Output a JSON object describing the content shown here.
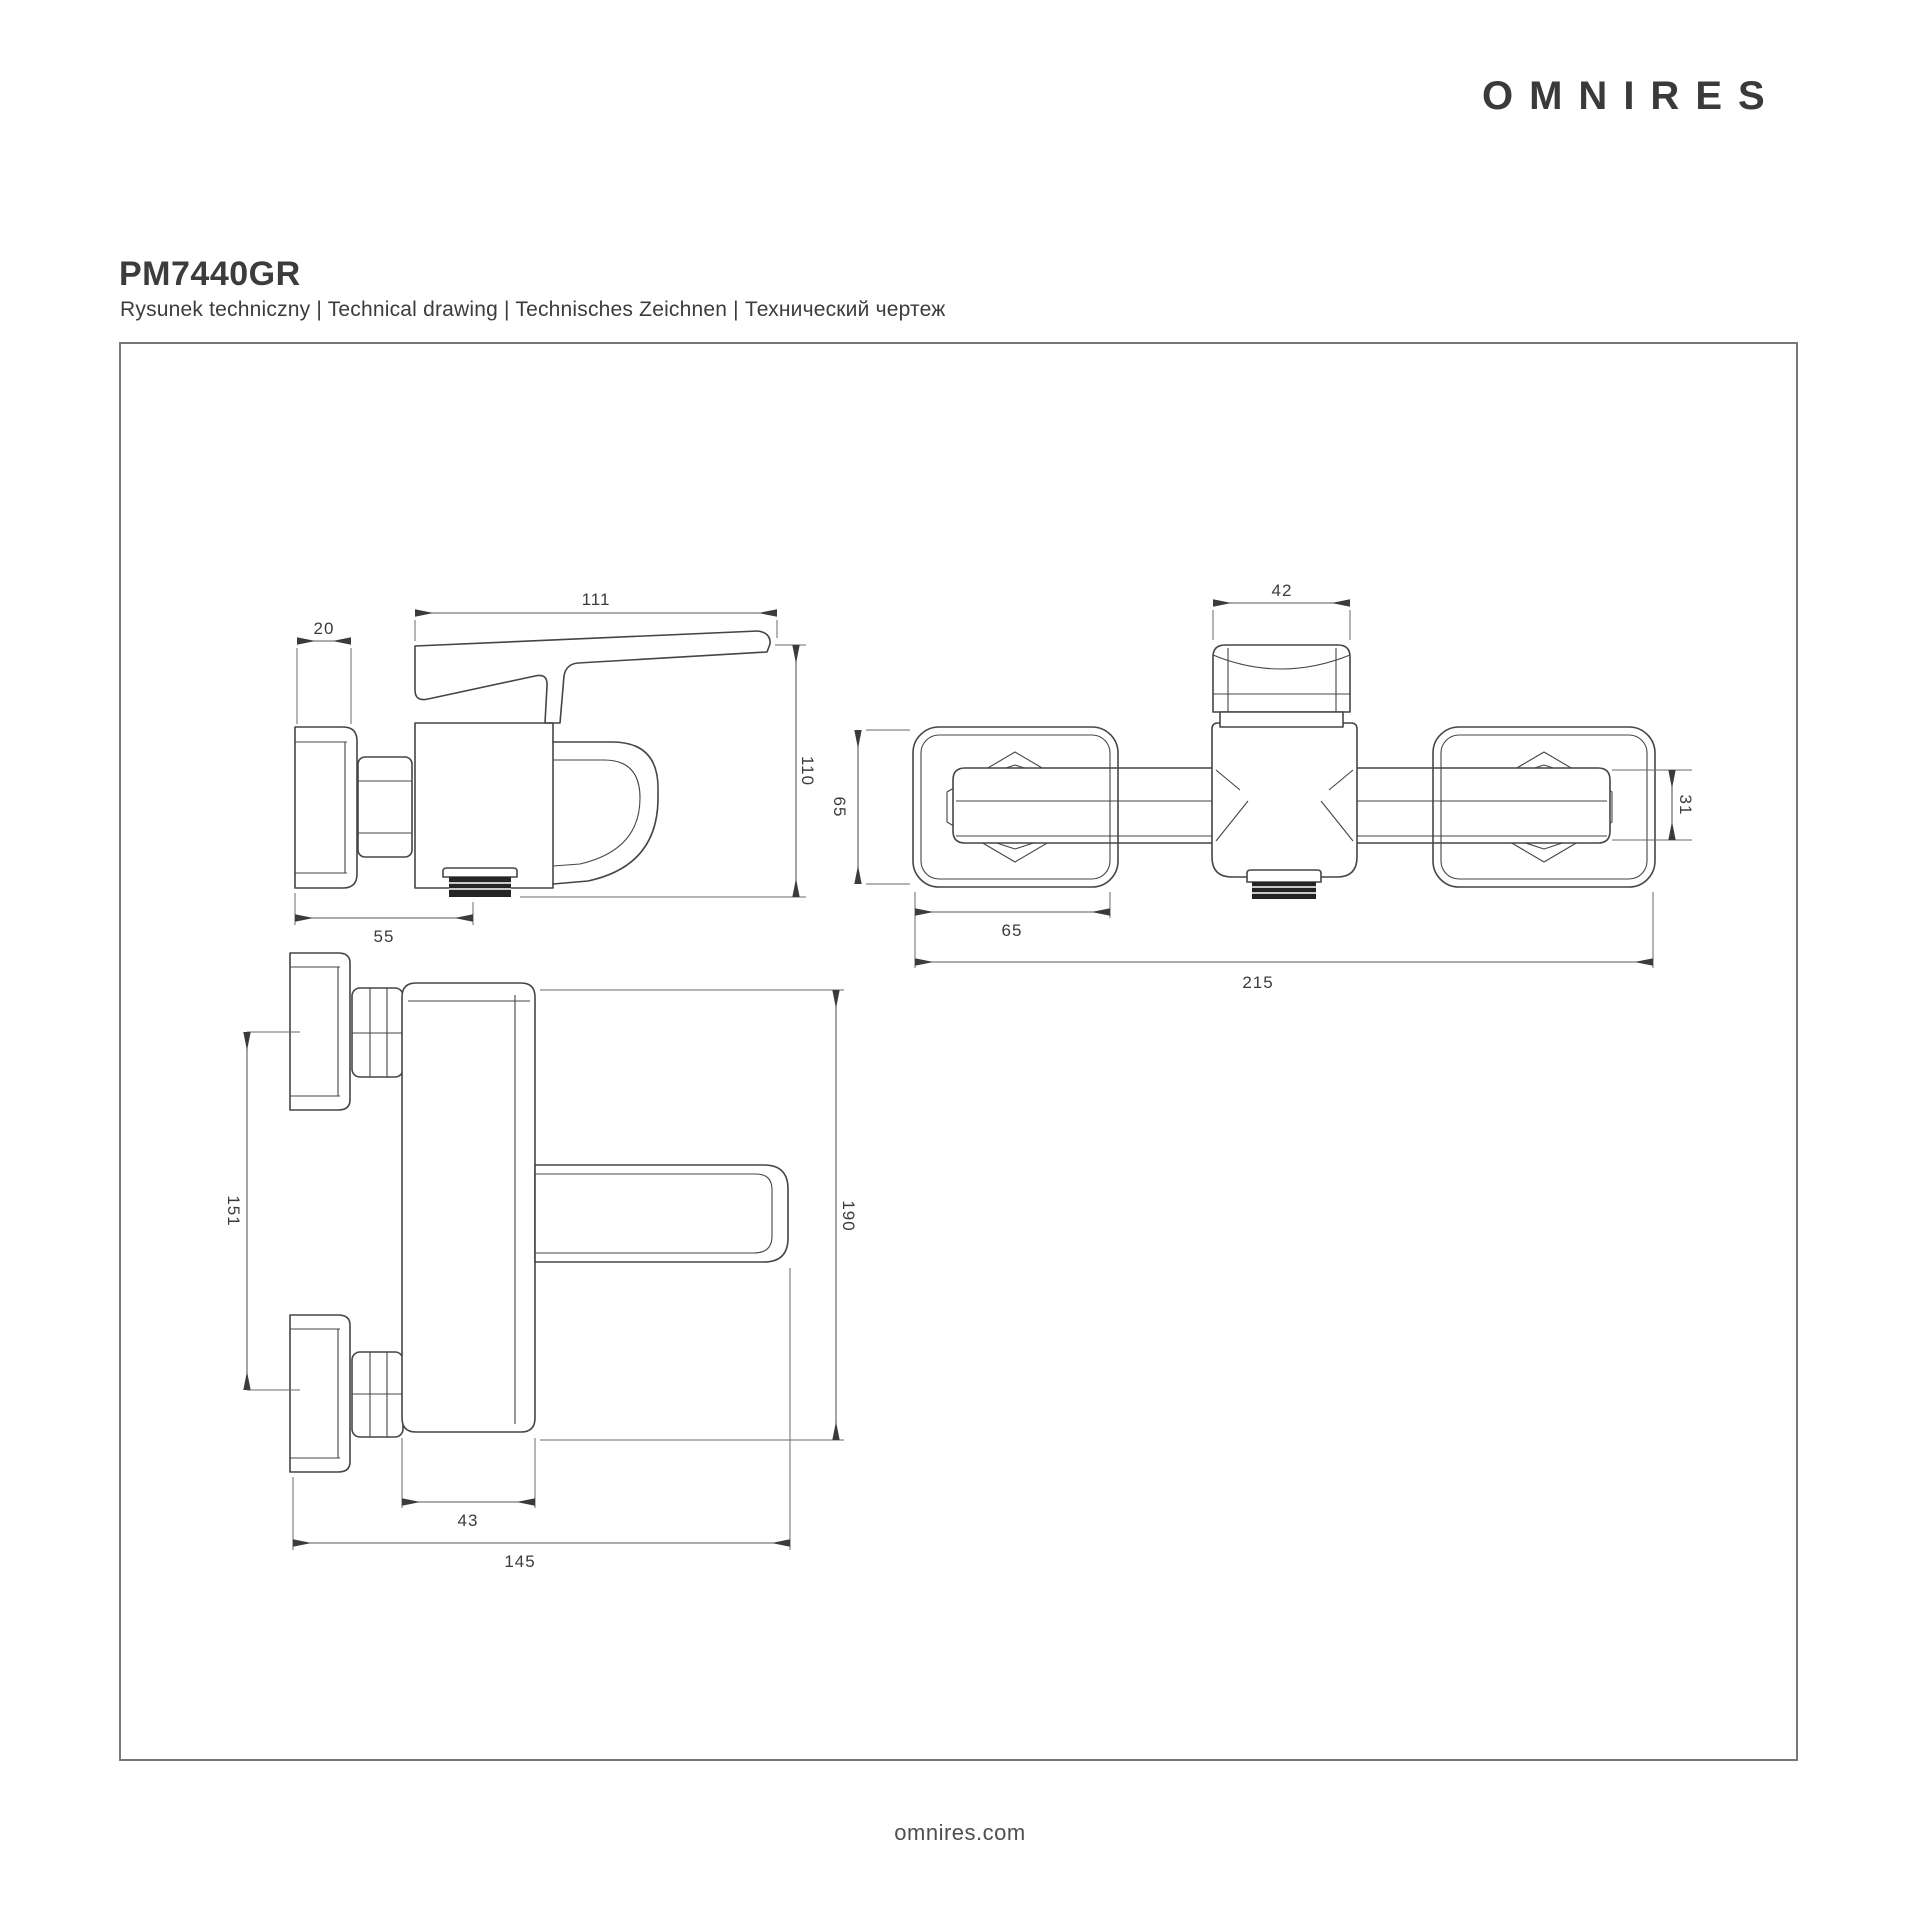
{
  "brand": {
    "logo_text": "OMNIRES",
    "website": "omnires.com"
  },
  "header": {
    "product_code": "PM7440GR",
    "subtitle": "Rysunek techniczny | Technical drawing | Technisches Zeichnen | Технический чертеж"
  },
  "colors": {
    "line": "#454547",
    "dim_line": "#5a5a5c",
    "text": "#3b3b3d",
    "frame": "#777777"
  },
  "drawing": {
    "type": "technical-drawing",
    "side_view": {
      "dims": {
        "flange_depth": "20",
        "lever_length": "111",
        "height": "110",
        "wall_to_spout": "55"
      }
    },
    "top_view": {
      "dims": {
        "handle_width": "42",
        "flange_height": "65",
        "flange_width": "65",
        "spout_width": "31",
        "total_length": "215"
      }
    },
    "front_view": {
      "dims": {
        "connection_spacing": "151",
        "total_height": "190",
        "body_width": "43",
        "total_width": "145"
      }
    }
  }
}
